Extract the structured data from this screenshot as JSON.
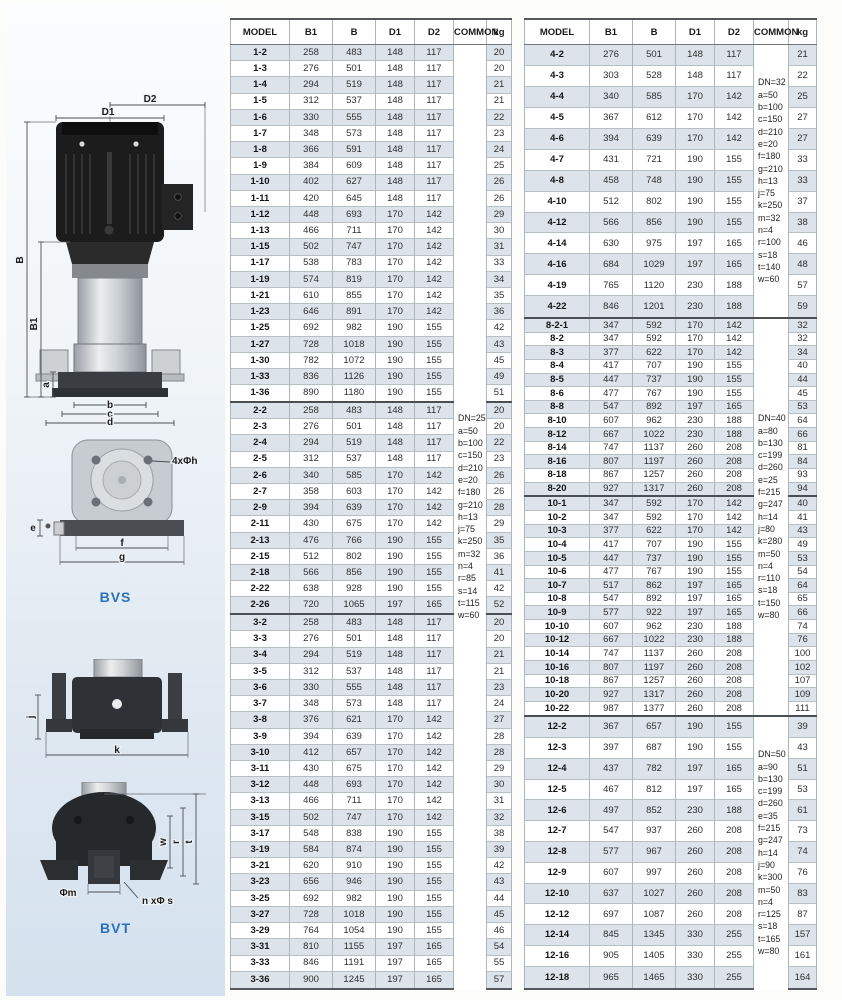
{
  "colors": {
    "accent_blue": "#2a72b8",
    "row_shade": "#dce3ea",
    "motor_black": "#1c1c1c",
    "base_gray": "#3a3e42"
  },
  "diagrams": {
    "pump": {
      "D2": "D2",
      "D1": "D1",
      "B": "B",
      "B1": "B1",
      "a": "a",
      "b": "b",
      "c": "c",
      "d": "d"
    },
    "bvs": {
      "caption": "BVS",
      "holes": "4xΦh",
      "e": "e",
      "f": "f",
      "g": "g"
    },
    "base_side": {
      "j": "j",
      "k": "k"
    },
    "bvt": {
      "caption": "BVT",
      "m": "Φm",
      "bolts": "n xΦ s",
      "w": "w",
      "r": "r",
      "t": "t"
    }
  },
  "tables": {
    "left": {
      "headers": [
        "MODEL",
        "B1",
        "B",
        "D1",
        "D2",
        "COMMON",
        "kg"
      ],
      "common_blocks": [
        {
          "start_group": 0,
          "end_group": 2,
          "lines": [
            "DN=25",
            "a=50",
            "b=100",
            "c=150",
            "d=210",
            "e=20",
            "f=180",
            "g=210",
            "h=13",
            "j=75",
            "k=250",
            "m=32",
            "n=4",
            "r=85",
            "s=14",
            "t=115",
            "w=60"
          ]
        }
      ],
      "groups": [
        {
          "rows": [
            [
              "1-2",
              258,
              483,
              148,
              117,
              20
            ],
            [
              "1-3",
              276,
              501,
              148,
              117,
              20
            ],
            [
              "1-4",
              294,
              519,
              148,
              117,
              21
            ],
            [
              "1-5",
              312,
              537,
              148,
              117,
              21
            ],
            [
              "1-6",
              330,
              555,
              148,
              117,
              22
            ],
            [
              "1-7",
              348,
              573,
              148,
              117,
              23
            ],
            [
              "1-8",
              366,
              591,
              148,
              117,
              24
            ],
            [
              "1-9",
              384,
              609,
              148,
              117,
              25
            ],
            [
              "1-10",
              402,
              627,
              148,
              117,
              26
            ],
            [
              "1-11",
              420,
              645,
              148,
              117,
              26
            ],
            [
              "1-12",
              448,
              693,
              170,
              142,
              29
            ],
            [
              "1-13",
              466,
              711,
              170,
              142,
              30
            ],
            [
              "1-15",
              502,
              747,
              170,
              142,
              31
            ],
            [
              "1-17",
              538,
              783,
              170,
              142,
              33
            ],
            [
              "1-19",
              574,
              819,
              170,
              142,
              34
            ],
            [
              "1-21",
              610,
              855,
              170,
              142,
              35
            ],
            [
              "1-23",
              646,
              891,
              170,
              142,
              36
            ],
            [
              "1-25",
              692,
              982,
              190,
              155,
              42
            ],
            [
              "1-27",
              728,
              1018,
              190,
              155,
              43
            ],
            [
              "1-30",
              782,
              1072,
              190,
              155,
              45
            ],
            [
              "1-33",
              836,
              1126,
              190,
              155,
              49
            ],
            [
              "1-36",
              890,
              1180,
              190,
              155,
              51
            ]
          ]
        },
        {
          "rows": [
            [
              "2-2",
              258,
              483,
              148,
              117,
              20
            ],
            [
              "2-3",
              276,
              501,
              148,
              117,
              20
            ],
            [
              "2-4",
              294,
              519,
              148,
              117,
              22
            ],
            [
              "2-5",
              312,
              537,
              148,
              117,
              23
            ],
            [
              "2-6",
              340,
              585,
              170,
              142,
              26
            ],
            [
              "2-7",
              358,
              603,
              170,
              142,
              26
            ],
            [
              "2-9",
              394,
              639,
              170,
              142,
              28
            ],
            [
              "2-11",
              430,
              675,
              170,
              142,
              29
            ],
            [
              "2-13",
              476,
              766,
              190,
              155,
              35
            ],
            [
              "2-15",
              512,
              802,
              190,
              155,
              36
            ],
            [
              "2-18",
              566,
              856,
              190,
              155,
              41
            ],
            [
              "2-22",
              638,
              928,
              190,
              155,
              42
            ],
            [
              "2-26",
              720,
              1065,
              197,
              165,
              52
            ]
          ]
        },
        {
          "rows": [
            [
              "3-2",
              258,
              483,
              148,
              117,
              20
            ],
            [
              "3-3",
              276,
              501,
              148,
              117,
              20
            ],
            [
              "3-4",
              294,
              519,
              148,
              117,
              21
            ],
            [
              "3-5",
              312,
              537,
              148,
              117,
              21
            ],
            [
              "3-6",
              330,
              555,
              148,
              117,
              23
            ],
            [
              "3-7",
              348,
              573,
              148,
              117,
              24
            ],
            [
              "3-8",
              376,
              621,
              170,
              142,
              27
            ],
            [
              "3-9",
              394,
              639,
              170,
              142,
              28
            ],
            [
              "3-10",
              412,
              657,
              170,
              142,
              28
            ],
            [
              "3-11",
              430,
              675,
              170,
              142,
              29
            ],
            [
              "3-12",
              448,
              693,
              170,
              142,
              30
            ],
            [
              "3-13",
              466,
              711,
              170,
              142,
              31
            ],
            [
              "3-15",
              502,
              747,
              170,
              142,
              32
            ],
            [
              "3-17",
              548,
              838,
              190,
              155,
              38
            ],
            [
              "3-19",
              584,
              874,
              190,
              155,
              39
            ],
            [
              "3-21",
              620,
              910,
              190,
              155,
              42
            ],
            [
              "3-23",
              656,
              946,
              190,
              155,
              43
            ],
            [
              "3-25",
              692,
              982,
              190,
              155,
              44
            ],
            [
              "3-27",
              728,
              1018,
              190,
              155,
              45
            ],
            [
              "3-29",
              764,
              1054,
              190,
              155,
              46
            ],
            [
              "3-31",
              810,
              1155,
              197,
              165,
              54
            ],
            [
              "3-33",
              846,
              1191,
              197,
              165,
              55
            ],
            [
              "3-36",
              900,
              1245,
              197,
              165,
              57
            ]
          ]
        }
      ]
    },
    "right": {
      "headers": [
        "MODEL",
        "B1",
        "B",
        "D1",
        "D2",
        "COMMON",
        "kg"
      ],
      "common_blocks": [
        {
          "start_group": 0,
          "end_group": 0,
          "lines": [
            "DN=32",
            "a=50",
            "b=100",
            "c=150",
            "d=210",
            "e=20",
            "f=180",
            "g=210",
            "h=13",
            "j=75",
            "k=250",
            "m=32",
            "n=4",
            "r=100",
            "s=18",
            "t=140",
            "w=60"
          ]
        },
        {
          "start_group": 1,
          "end_group": 2,
          "lines": [
            "DN=40",
            "a=80",
            "b=130",
            "c=199",
            "d=260",
            "e=25",
            "f=215",
            "g=247",
            "h=14",
            "j=80",
            "k=280",
            "m=50",
            "n=4",
            "r=110",
            "s=18",
            "t=150",
            "w=80"
          ]
        },
        {
          "start_group": 3,
          "end_group": 3,
          "lines": [
            "DN=50",
            "a=90",
            "b=130",
            "c=199",
            "d=260",
            "e=35",
            "f=215",
            "g=247",
            "h=14",
            "j=90",
            "k=300",
            "m=50",
            "n=4",
            "r=125",
            "s=18",
            "t=165",
            "w=80"
          ]
        }
      ],
      "groups": [
        {
          "rows": [
            [
              "4-2",
              276,
              501,
              148,
              117,
              21
            ],
            [
              "4-3",
              303,
              528,
              148,
              117,
              22
            ],
            [
              "4-4",
              340,
              585,
              170,
              142,
              25
            ],
            [
              "4-5",
              367,
              612,
              170,
              142,
              27
            ],
            [
              "4-6",
              394,
              639,
              170,
              142,
              27
            ],
            [
              "4-7",
              431,
              721,
              190,
              155,
              33
            ],
            [
              "4-8",
              458,
              748,
              190,
              155,
              33
            ],
            [
              "4-10",
              512,
              802,
              190,
              155,
              37
            ],
            [
              "4-12",
              566,
              856,
              190,
              155,
              38
            ],
            [
              "4-14",
              630,
              975,
              197,
              165,
              46
            ],
            [
              "4-16",
              684,
              1029,
              197,
              165,
              48
            ],
            [
              "4-19",
              765,
              1120,
              230,
              188,
              57
            ],
            [
              "4-22",
              846,
              1201,
              230,
              188,
              59
            ]
          ]
        },
        {
          "rows": [
            [
              "8-2-1",
              347,
              592,
              170,
              142,
              32
            ],
            [
              "8-2",
              347,
              592,
              170,
              142,
              32
            ],
            [
              "8-3",
              377,
              622,
              170,
              142,
              34
            ],
            [
              "8-4",
              417,
              707,
              190,
              155,
              40
            ],
            [
              "8-5",
              447,
              737,
              190,
              155,
              44
            ],
            [
              "8-6",
              477,
              767,
              190,
              155,
              45
            ],
            [
              "8-8",
              547,
              892,
              197,
              165,
              53
            ],
            [
              "8-10",
              607,
              962,
              230,
              188,
              64
            ],
            [
              "8-12",
              667,
              1022,
              230,
              188,
              66
            ],
            [
              "8-14",
              747,
              1137,
              260,
              208,
              81
            ],
            [
              "8-16",
              807,
              1197,
              260,
              208,
              84
            ],
            [
              "8-18",
              867,
              1257,
              260,
              208,
              93
            ],
            [
              "8-20",
              927,
              1317,
              260,
              208,
              94
            ]
          ]
        },
        {
          "rows": [
            [
              "10-1",
              347,
              592,
              170,
              142,
              40
            ],
            [
              "10-2",
              347,
              592,
              170,
              142,
              41
            ],
            [
              "10-3",
              377,
              622,
              170,
              142,
              43
            ],
            [
              "10-4",
              417,
              707,
              190,
              155,
              49
            ],
            [
              "10-5",
              447,
              737,
              190,
              155,
              53
            ],
            [
              "10-6",
              477,
              767,
              190,
              155,
              54
            ],
            [
              "10-7",
              517,
              862,
              197,
              165,
              64
            ],
            [
              "10-8",
              547,
              892,
              197,
              165,
              65
            ],
            [
              "10-9",
              577,
              922,
              197,
              165,
              66
            ],
            [
              "10-10",
              607,
              962,
              230,
              188,
              74
            ],
            [
              "10-12",
              667,
              1022,
              230,
              188,
              76
            ],
            [
              "10-14",
              747,
              1137,
              260,
              208,
              100
            ],
            [
              "10-16",
              807,
              1197,
              260,
              208,
              102
            ],
            [
              "10-18",
              867,
              1257,
              260,
              208,
              107
            ],
            [
              "10-20",
              927,
              1317,
              260,
              208,
              109
            ],
            [
              "10-22",
              987,
              1377,
              260,
              208,
              111
            ]
          ]
        },
        {
          "rows": [
            [
              "12-2",
              367,
              657,
              190,
              155,
              39
            ],
            [
              "12-3",
              397,
              687,
              190,
              155,
              43
            ],
            [
              "12-4",
              437,
              782,
              197,
              165,
              51
            ],
            [
              "12-5",
              467,
              812,
              197,
              165,
              53
            ],
            [
              "12-6",
              497,
              852,
              230,
              188,
              61
            ],
            [
              "12-7",
              547,
              937,
              260,
              208,
              73
            ],
            [
              "12-8",
              577,
              967,
              260,
              208,
              74
            ],
            [
              "12-9",
              607,
              997,
              260,
              208,
              76
            ],
            [
              "12-10",
              637,
              1027,
              260,
              208,
              83
            ],
            [
              "12-12",
              697,
              1087,
              260,
              208,
              87
            ],
            [
              "12-14",
              845,
              1345,
              330,
              255,
              157
            ],
            [
              "12-16",
              905,
              1405,
              330,
              255,
              161
            ],
            [
              "12-18",
              965,
              1465,
              330,
              255,
              164
            ]
          ]
        }
      ]
    }
  }
}
